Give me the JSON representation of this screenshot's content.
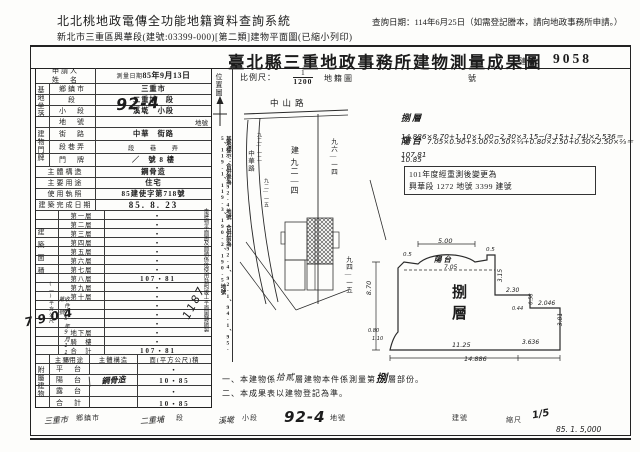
{
  "header": {
    "system_title": "北北桃地政電傳全功能地籍資料查詢系統",
    "doc_line": "新北市三重區興華段(建號:03399-000)[第二類]建物平面圖(已縮小列印)",
    "query_date_note": "查詢日期：114年6月25日（如需登記謄本，請向地政事務所申請。）"
  },
  "title": {
    "main": "臺北縣三重地政事務所建物測量成果圖",
    "building_no_label": "建號：",
    "building_no": "9058"
  },
  "table": {
    "applicant_label_1": "申請人",
    "applicant_label_2": "姓　名",
    "survey_label": "測量日期",
    "survey_value": "85年9月13日",
    "site": {
      "group": "基地坐落",
      "rows": [
        {
          "label": "鄉鎮市",
          "value": "三重市"
        },
        {
          "label": "段",
          "value": "二重埔　段"
        },
        {
          "label": "小　段",
          "value": "溪墘　小段"
        },
        {
          "label": "地　號",
          "value": "地號",
          "hand": "92-4"
        }
      ]
    },
    "address": {
      "group": "建物門牌",
      "rows": [
        {
          "label": "街　路",
          "value": "中華　街路"
        },
        {
          "label": "段巷弄",
          "value": "段　　巷　　弄"
        },
        {
          "label": "門　牌",
          "value": "／　號 8 樓"
        }
      ]
    },
    "simple_rows": [
      {
        "label": "主體構造",
        "value": "鋼骨造"
      },
      {
        "label": "主要用途",
        "value": "住宅"
      },
      {
        "label": "使用執照",
        "value": "85建使字第718號"
      },
      {
        "label": "建築完成日期",
        "value": "85. 8. 23"
      }
    ],
    "area": {
      "group": "建築面積",
      "unit": "(一)平方公尺",
      "rows": [
        {
          "label": "第一層",
          "value": "・"
        },
        {
          "label": "第二層",
          "value": "・"
        },
        {
          "label": "第三層",
          "value": "・"
        },
        {
          "label": "第四層",
          "value": "・"
        },
        {
          "label": "第五層",
          "value": "・"
        },
        {
          "label": "第六層",
          "value": "・"
        },
        {
          "label": "第七層",
          "value": "・"
        },
        {
          "label": "第八層",
          "value": "107・81"
        },
        {
          "label": "第九層",
          "value": "・"
        },
        {
          "label": "第十層",
          "value": "・"
        },
        {
          "label": "",
          "value": "・"
        },
        {
          "label": "",
          "value": "・"
        },
        {
          "label": "",
          "value": "・"
        },
        {
          "label": "地下層",
          "value": "・"
        },
        {
          "label": "騎　樓",
          "value": "・"
        },
        {
          "label": "合　計",
          "value": "107・81"
        }
      ]
    },
    "annex": {
      "group": "附屬建物",
      "headers": [
        "主要用途",
        "主體構造",
        "面(平方公尺)積"
      ],
      "rows": [
        {
          "use": "平　台",
          "struct": "",
          "area": "・"
        },
        {
          "use": "陽　台",
          "struct": "鋼骨造",
          "area": "10・85"
        },
        {
          "use": "露　台",
          "struct": "",
          "area": "・"
        },
        {
          "use": "合　計",
          "struct": "",
          "area": "10・85"
        }
      ]
    },
    "stamps": {
      "receipt_no": "7904",
      "old_building_no": "1187",
      "receipt_text": "收件85年9月11日第　號"
    }
  },
  "strip": {
    "heading": "位置圖",
    "note_transcribe": "本建物平面圖及面積係依使用執照竣工平面圖轉繪製",
    "note_site": "基地標示：合併後為92-4地號　合併前為92-4、92-1、94-1、95-5、119-1、119-3、190-2、190-5地號"
  },
  "drawing": {
    "scale_label": "比例尺：",
    "scale_numerator": "1",
    "scale_denominator": "1200",
    "map_label": "地籍圖",
    "no_label": "號",
    "sketch": {
      "road_top": "中山路",
      "road_left": "中華路",
      "parcel_main_prefix": "建",
      "parcel_main": "九二—四",
      "parcel_right": "九六—一四",
      "parcel_right_lower": "九四—一五",
      "parcel_left_1": "九二—一二",
      "parcel_left_2": "九二—一五"
    },
    "formulas": [
      {
        "label": "捌層",
        "expr": "14.886×8.70+1.10×1.00−2.30×3.15−(3.15+1.74)×2.536＝107.81"
      },
      {
        "label": "陽台",
        "expr": "7.05×0.90+5.00×0.50×⅔+0.80×2.50+0.50×2.50×⅔＝10.85"
      }
    ],
    "remark_box_line1": "101年度經重測後變更為",
    "remark_box_line2": "興華段 1272 地號 3399 建號",
    "plan": {
      "floor_label": "捌層",
      "balcony_label": "陽台",
      "dim_top": "5.00",
      "dim_balcony": "7.05",
      "dim_left": "8.70",
      "dim_right_upper": "3.15",
      "dim_step": "2.30",
      "dim_small_a": "0.5",
      "dim_small_b": "0.5",
      "dim_small_c": "0.58",
      "dim_small_d": "0.44",
      "dim_seg": "2.046",
      "dim_right_lower": "3.81",
      "dim_bottom_left": "11.25",
      "dim_bottom_total": "14.886",
      "dim_bottom_right": "3.636",
      "dim_bump_a": "0.80",
      "dim_bump_b": "1.10"
    }
  },
  "notes": {
    "n1_prefix": "一、本建物係",
    "n1_hand": "拾貳",
    "n1_mid": "層建物本件係測量第",
    "n1_hand2": "捌",
    "n1_suffix": "層部份。",
    "n2": "二、本成果表以建物登記為準。"
  },
  "bottom_strip": {
    "items": [
      {
        "hand": "三重市",
        "label": "鄉鎮市"
      },
      {
        "hand": "二重埔",
        "label": "段"
      },
      {
        "hand": "溪墘",
        "label": "小段"
      },
      {
        "hand": "92-4",
        "label": "地號"
      },
      {
        "hand": "",
        "label": "建號"
      },
      {
        "hand": "1/5",
        "label": "縮尺"
      }
    ],
    "print_note": "85. 1. 5,000"
  }
}
